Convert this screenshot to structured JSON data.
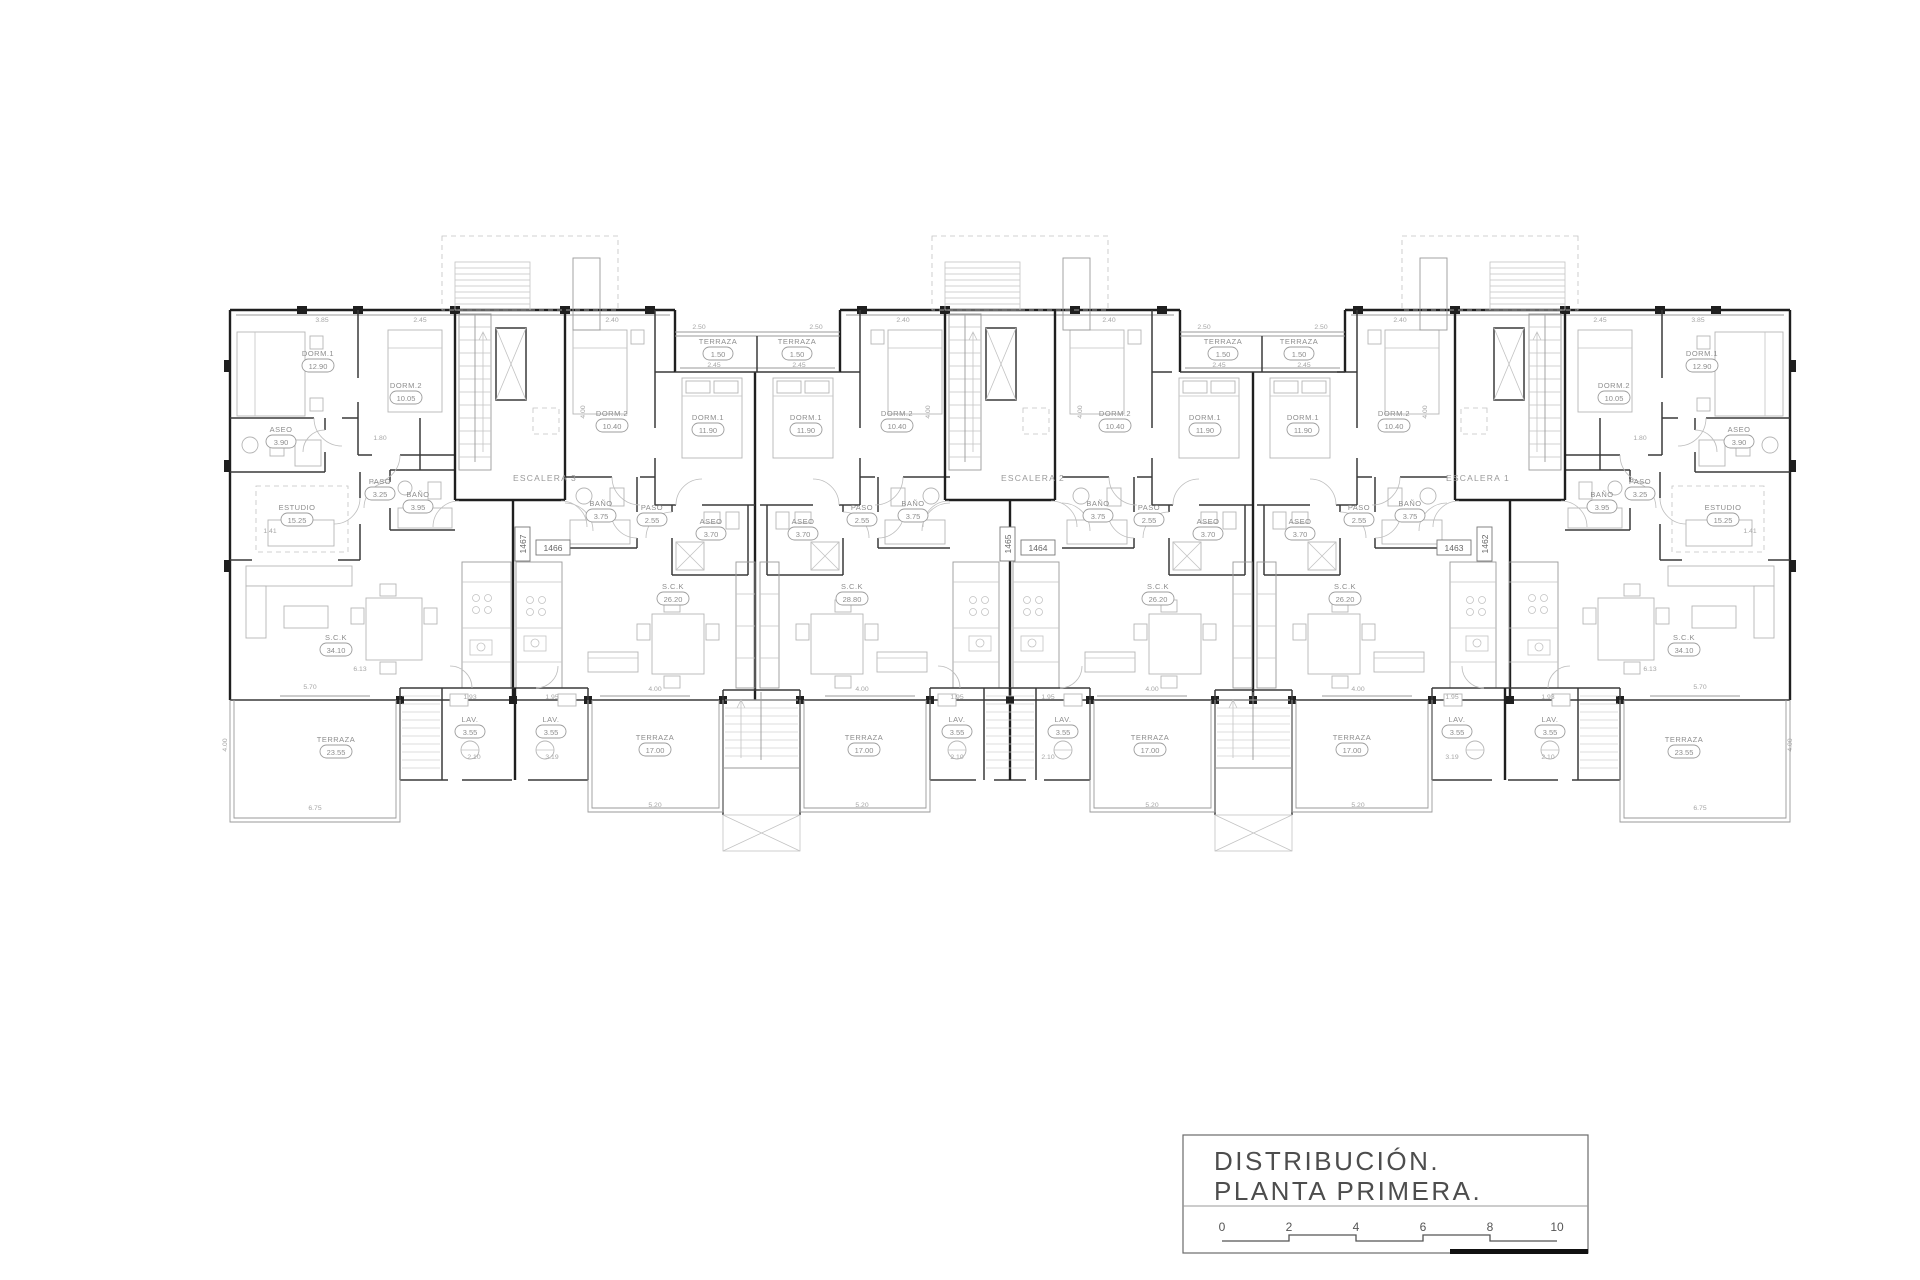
{
  "drawing": {
    "title_line1": "DISTRIBUCIÓN.",
    "title_line2": "PLANTA  PRIMERA.",
    "scale_ticks": [
      "0",
      "2",
      "4",
      "6",
      "8",
      "10"
    ]
  },
  "colors": {
    "paper": "#ffffff",
    "wall": "#1f1f1f",
    "annotation": "#8d8d8d",
    "title": "#4d4d4d"
  },
  "stairs": [
    {
      "label": "ESCALERA 3"
    },
    {
      "label": "ESCALERA 2"
    },
    {
      "label": "ESCALERA 1"
    }
  ],
  "unit_tags": [
    {
      "id": "1466"
    },
    {
      "id": "1464"
    },
    {
      "id": "1463"
    },
    {
      "id": "1467"
    },
    {
      "id": "1465"
    },
    {
      "id": "1462"
    }
  ],
  "rooms": [
    {
      "name": "DORM.1",
      "area": "12.90"
    },
    {
      "name": "DORM.2",
      "area": "10.05"
    },
    {
      "name": "ASEO",
      "area": "3.90"
    },
    {
      "name": "PASO",
      "area": "3.25"
    },
    {
      "name": "BAÑO",
      "area": "3.95"
    },
    {
      "name": "ESTUDIO",
      "area": "15.25"
    },
    {
      "name": "S.C.K",
      "area": "34.10"
    },
    {
      "name": "TERRAZA",
      "area": "23.55"
    },
    {
      "name": "LAV.",
      "area": "3.55"
    },
    {
      "name": "DORM.2",
      "area": "10.40"
    },
    {
      "name": "DORM.1",
      "area": "11.90"
    },
    {
      "name": "BAÑO",
      "area": "3.75"
    },
    {
      "name": "PASO",
      "area": "2.55"
    },
    {
      "name": "ASEO",
      "area": "3.70"
    },
    {
      "name": "TERRAZA",
      "area": "1.50"
    },
    {
      "name": "S.C.K",
      "area": "26.20"
    },
    {
      "name": "TERRAZA",
      "area": "17.00"
    },
    {
      "name": "LAV.",
      "area": "3.55"
    },
    {
      "name": "DORM.1",
      "area": "11.90"
    },
    {
      "name": "DORM.2",
      "area": "10.40"
    },
    {
      "name": "ASEO",
      "area": "3.70"
    },
    {
      "name": "PASO",
      "area": "2.55"
    },
    {
      "name": "BAÑO",
      "area": "3.75"
    },
    {
      "name": "TERRAZA",
      "area": "1.50"
    },
    {
      "name": "S.C.K",
      "area": "28.80"
    },
    {
      "name": "TERRAZA",
      "area": "17.00"
    },
    {
      "name": "LAV.",
      "area": "3.55"
    },
    {
      "name": "DORM.2",
      "area": "10.40"
    },
    {
      "name": "DORM.1",
      "area": "11.90"
    },
    {
      "name": "BAÑO",
      "area": "3.75"
    },
    {
      "name": "PASO",
      "area": "2.55"
    },
    {
      "name": "ASEO",
      "area": "3.70"
    },
    {
      "name": "TERRAZA",
      "area": "1.50"
    },
    {
      "name": "S.C.K",
      "area": "26.20"
    },
    {
      "name": "TERRAZA",
      "area": "17.00"
    },
    {
      "name": "LAV.",
      "area": "3.55"
    },
    {
      "name": "DORM.1",
      "area": "11.90"
    },
    {
      "name": "DORM.2",
      "area": "10.40"
    },
    {
      "name": "ASEO",
      "area": "3.70"
    },
    {
      "name": "PASO",
      "area": "2.55"
    },
    {
      "name": "BAÑO",
      "area": "3.75"
    },
    {
      "name": "TERRAZA",
      "area": "1.50"
    },
    {
      "name": "S.C.K",
      "area": "26.20"
    },
    {
      "name": "TERRAZA",
      "area": "17.00"
    },
    {
      "name": "LAV.",
      "area": "3.55"
    },
    {
      "name": "DORM.2",
      "area": "10.05"
    },
    {
      "name": "DORM.1",
      "area": "12.90"
    },
    {
      "name": "ASEO",
      "area": "3.90"
    },
    {
      "name": "PASO",
      "area": "3.25"
    },
    {
      "name": "BAÑO",
      "area": "3.95"
    },
    {
      "name": "ESTUDIO",
      "area": "15.25"
    },
    {
      "name": "S.C.K",
      "area": "34.10"
    },
    {
      "name": "TERRAZA",
      "area": "23.55"
    },
    {
      "name": "LAV.",
      "area": "3.55"
    }
  ],
  "dims": [
    "3.85",
    "2.45",
    "2.40",
    "2.50",
    "2.50",
    "2.40",
    "2.40",
    "2.50",
    "2.50",
    "2.40",
    "2.45",
    "3.85",
    "2.45",
    "2.45",
    "2.45",
    "2.45",
    "4.00",
    "4.00",
    "4.00",
    "4.00",
    "1.80",
    "1.80",
    "1.41",
    "1.41",
    "6.13",
    "5.70",
    "6.13",
    "5.70",
    "6.75",
    "6.75",
    "5.20",
    "5.20",
    "5.20",
    "5.20",
    "4.00",
    "4.00",
    "4.00",
    "4.00",
    "1.93",
    "1.95",
    "1.95",
    "1.95",
    "1.95",
    "1.93",
    "2.10",
    "3.19",
    "2.10",
    "2.10",
    "3.19",
    "2.10",
    "4.00",
    "4.00"
  ]
}
